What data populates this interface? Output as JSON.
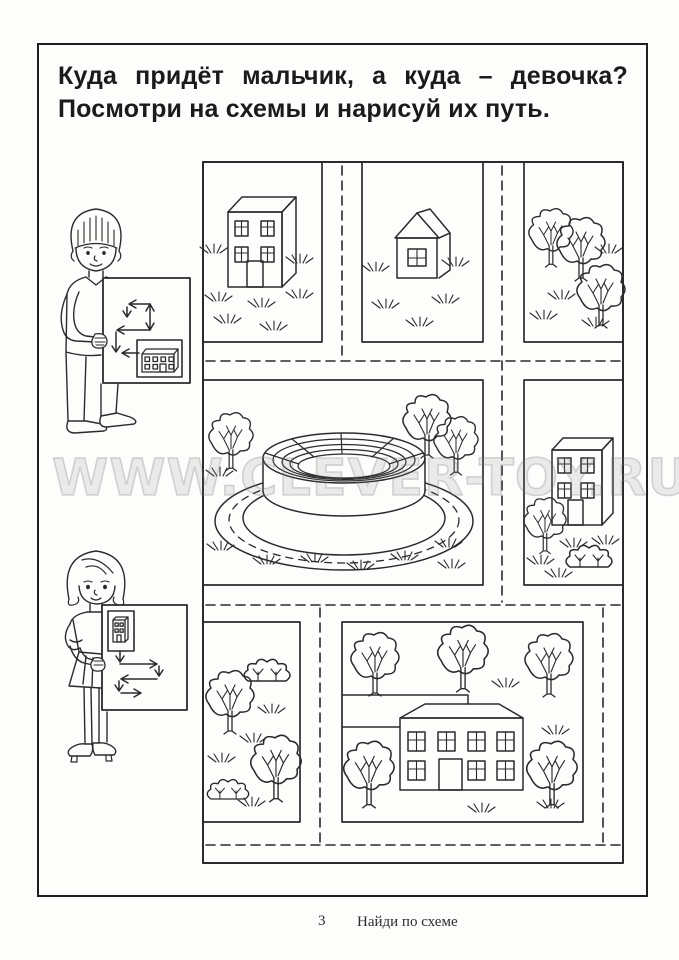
{
  "page": {
    "title_line1": "Куда придёт мальчик, а куда – девочка?",
    "title_line2": "Посмотри на схемы и нарисуй их путь.",
    "watermark": "WWW.CLEVER-TOY.RU",
    "footer": {
      "page_number": "3",
      "label": "Найди по схеме"
    },
    "ink_color": "#2b2b2b",
    "watermark_color": "#c9c9c9"
  },
  "scene": {
    "characters": [
      {
        "id": "boy",
        "name": "boy-holding-route-scheme-card",
        "card_content": "arrow-route-scheme-ending-at-apartment-building-icon"
      },
      {
        "id": "girl",
        "name": "girl-holding-route-scheme-card",
        "card_content": "building-icon-then-arrow-route-scheme"
      }
    ],
    "map_panels": [
      {
        "id": "p1",
        "content": "apartment-building"
      },
      {
        "id": "p2",
        "content": "small-house"
      },
      {
        "id": "p3",
        "content": "three-trees"
      },
      {
        "id": "p4",
        "content": "round-stadium-with-ring-road"
      },
      {
        "id": "p5",
        "content": "apartment-building-with-tree-and-bush"
      },
      {
        "id": "p6",
        "content": "trees-and-bushes"
      },
      {
        "id": "p7",
        "content": "large-house-with-trees-and-fence"
      }
    ]
  }
}
